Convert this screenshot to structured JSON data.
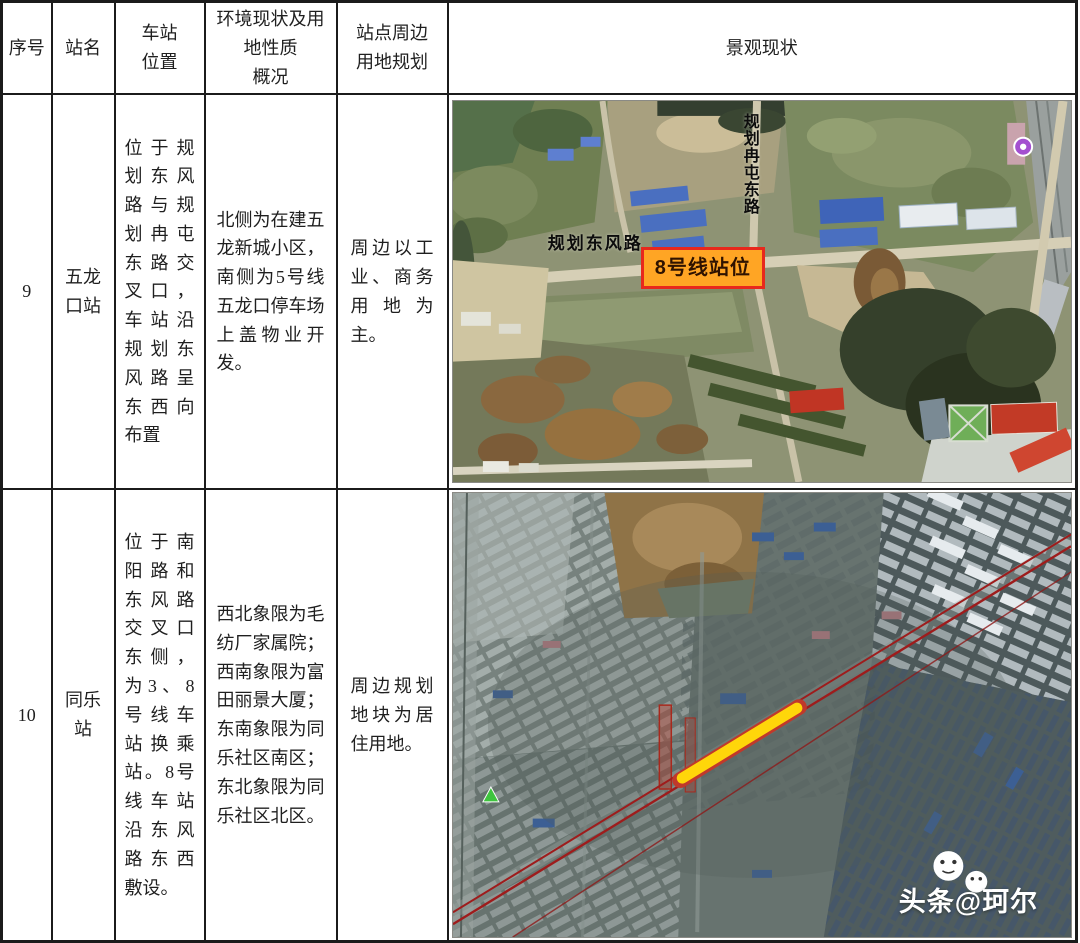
{
  "table": {
    "headers": [
      "序号",
      "站名",
      "车站\n位置",
      "环境现状及用\n地性质\n概况",
      "站点周边\n用地规划",
      "景观现状"
    ],
    "rows": [
      {
        "no": "9",
        "name": "五龙口站",
        "location": "位于规划东风路与规划冉屯东路交叉口，车站沿规划东风路呈东西向布置",
        "environment": "北侧为在建五龙新城小区，南侧为5号线五龙口停车场上盖物业开发。",
        "planning": "周边以工业、商务用地为主。"
      },
      {
        "no": "10",
        "name": "同乐站",
        "location": "位于南阳路和东风路交叉口东侧，为3、8号线车站换乘站。8号线车站沿东风路东西敷设。",
        "environment": "西北象限为毛纺厂家属院；西南象限为富田丽景大厦；东南象限为同乐社区南区；东北象限为同乐社区北区。",
        "planning": "周边规划地块为居住用地。"
      }
    ]
  },
  "map1": {
    "road_vertical_label": "规划冉屯东路",
    "road_horizontal_label": "规划东风路",
    "station_badge": "8号线站位"
  },
  "map2": {
    "watermark": "头条@珂尔"
  },
  "colors": {
    "station_badge_bg": "#ffa524",
    "station_badge_border": "#e8281c",
    "route_line_red": "#9e1c1c",
    "station_segment_yellow": "#ffd60a",
    "table_border": "#1b1b1b"
  }
}
